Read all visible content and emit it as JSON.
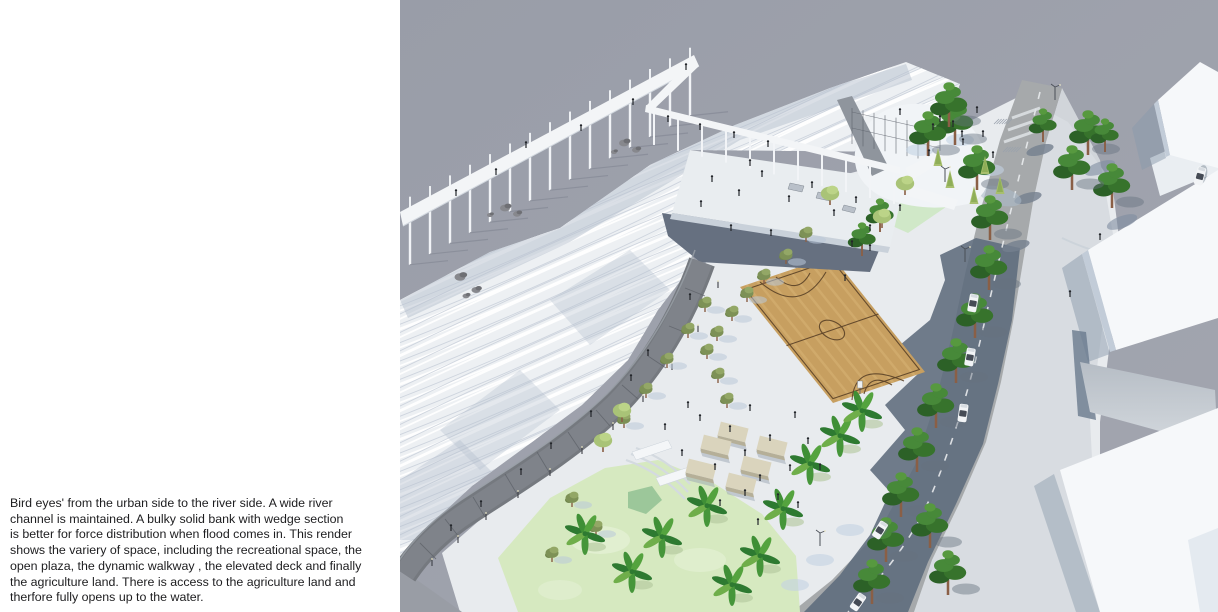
{
  "page": {
    "background": "#ffffff",
    "title": "Bird's eye architectural render page"
  },
  "caption": {
    "color": "#1d1d1f",
    "lines": [
      "Bird eyes' from the urban side to the river side. A wide river",
      "channel is maintained. A bulky solid bank with wedge section",
      "is better for force distribution when flood comes in. This render",
      "shows the variery of space, including the recreational space, the",
      "open plaza, the dynamic walkway , the elevated deck and finally",
      "the agriculture land. There is access to the agriculture land and",
      "therfore fully opens up to the water."
    ]
  },
  "render": {
    "x": 400,
    "width": 818,
    "height": 612,
    "palette": {
      "bg_a": "#999da8",
      "bg_b": "#a3a6b0",
      "white_structure": "#f3f5f7",
      "ground": "#e8ebee",
      "stripe_base": "#edf0f3",
      "stripe_shadow": "#b5bfce",
      "furrow": "#c6cdd8",
      "walkway": "#75797f",
      "walkway_inner": "#7f838a",
      "wedge": "#999da5",
      "road": "#a6a9ab",
      "road_shadow": "#5d6b7c",
      "sidewalk": "#d6dadf",
      "lane": "#e9ebed",
      "court": "#c79f60",
      "court_streak": "#d7b376",
      "court_line": "#5a4127",
      "grass": "#d6e9c0",
      "grass_light": "#e3f0d3",
      "grass_top": "#cfe8c5",
      "pond": "#9cc79a",
      "tree_dark": "#2c6127",
      "tree_mid": "#37732c",
      "tree_hi": "#478939",
      "tree_top": "#57993f",
      "olive": "#7d9156",
      "olive_hi": "#93a766",
      "light_tree": "#a9c377",
      "light_tree_hi": "#bcd488",
      "banana": "#2e7a31",
      "banana_hi": "#54a33e",
      "conifer": "#a8bf6e",
      "trunk": "#8a5f46",
      "trunk_banana": "#996b4e",
      "bench_top": "#dad4bd",
      "bench_side": "#b5af98",
      "car_body": "#f2f4f6",
      "car_glass": "#454b55",
      "people": "#23262b",
      "rock_a": "#87888d",
      "rock_b": "#6e6f74",
      "shadow_blue": "#b9c8d8",
      "building": "#f6f8fa",
      "building_side": "#c2ccd8",
      "building_shadow": "#8a99ab",
      "underdeck": "#667080",
      "deck": "#e9edf0"
    },
    "scene": {
      "people": [
        [
          56,
          196
        ],
        [
          96,
          175
        ],
        [
          126,
          148
        ],
        [
          181,
          131
        ],
        [
          233,
          105
        ],
        [
          286,
          70
        ],
        [
          268,
          122
        ],
        [
          300,
          130
        ],
        [
          334,
          138
        ],
        [
          368,
          147
        ],
        [
          312,
          182
        ],
        [
          339,
          196
        ],
        [
          362,
          177
        ],
        [
          389,
          202
        ],
        [
          412,
          188
        ],
        [
          434,
          216
        ],
        [
          456,
          203
        ],
        [
          470,
          231
        ],
        [
          350,
          166
        ],
        [
          301,
          207
        ],
        [
          331,
          231
        ],
        [
          371,
          236
        ],
        [
          500,
          115
        ],
        [
          533,
          130
        ],
        [
          553,
          127
        ],
        [
          562,
          137
        ],
        [
          577,
          113
        ],
        [
          583,
          137
        ],
        [
          563,
          145
        ],
        [
          593,
          158
        ],
        [
          540,
          122
        ],
        [
          529,
          156
        ],
        [
          500,
          211
        ],
        [
          470,
          251
        ],
        [
          445,
          281
        ],
        [
          248,
          356
        ],
        [
          231,
          381
        ],
        [
          191,
          417
        ],
        [
          151,
          449
        ],
        [
          121,
          475
        ],
        [
          81,
          507
        ],
        [
          51,
          531
        ],
        [
          290,
          300
        ],
        [
          330,
          432
        ],
        [
          345,
          456
        ],
        [
          360,
          481
        ],
        [
          315,
          470
        ],
        [
          350,
          411
        ],
        [
          300,
          421
        ],
        [
          370,
          441
        ],
        [
          390,
          471
        ],
        [
          345,
          496
        ],
        [
          320,
          506
        ],
        [
          282,
          456
        ],
        [
          265,
          430
        ],
        [
          288,
          408
        ],
        [
          395,
          418
        ],
        [
          408,
          444
        ],
        [
          420,
          470
        ],
        [
          378,
          500
        ],
        [
          398,
          508
        ],
        [
          358,
          525
        ],
        [
          670,
          297
        ],
        [
          700,
          240
        ],
        [
          452,
          247
        ]
      ],
      "trees_pine_big": [
        [
          555,
          145
        ],
        [
          577,
          190
        ],
        [
          590,
          240
        ],
        [
          589,
          290
        ],
        [
          575,
          338
        ],
        [
          556,
          383
        ],
        [
          536,
          428
        ],
        [
          517,
          472
        ],
        [
          501,
          517
        ],
        [
          486,
          562
        ],
        [
          472,
          604
        ],
        [
          688,
          155
        ],
        [
          712,
          208
        ],
        [
          672,
          190
        ],
        [
          530,
          548
        ],
        [
          548,
          595
        ],
        [
          528,
          156
        ],
        [
          549,
          127
        ]
      ],
      "trees_pine": [
        [
          643,
          142
        ],
        [
          705,
          152
        ],
        [
          480,
          232
        ],
        [
          462,
          256
        ]
      ],
      "trees_olive": [
        [
          406,
          242
        ],
        [
          386,
          264
        ],
        [
          364,
          284
        ],
        [
          347,
          302
        ],
        [
          332,
          321
        ],
        [
          317,
          341
        ],
        [
          307,
          359
        ],
        [
          318,
          383
        ],
        [
          327,
          408
        ],
        [
          224,
          428
        ],
        [
          246,
          398
        ],
        [
          267,
          368
        ],
        [
          288,
          338
        ],
        [
          305,
          312
        ],
        [
          172,
          507
        ],
        [
          196,
          536
        ],
        [
          152,
          562
        ]
      ],
      "trees_light": [
        [
          505,
          195
        ],
        [
          482,
          228
        ],
        [
          222,
          422
        ],
        [
          203,
          452
        ],
        [
          430,
          205
        ]
      ],
      "trees_banana": [
        [
          232,
          583
        ],
        [
          307,
          517
        ],
        [
          360,
          567
        ],
        [
          383,
          520
        ],
        [
          410,
          475
        ],
        [
          440,
          447
        ],
        [
          462,
          422
        ],
        [
          185,
          545
        ],
        [
          262,
          548
        ],
        [
          332,
          596
        ]
      ],
      "trees_conifer": [
        [
          538,
          170
        ],
        [
          550,
          192
        ],
        [
          585,
          178
        ],
        [
          600,
          198
        ],
        [
          574,
          208
        ]
      ],
      "cars": [
        [
          573,
          303,
          -80
        ],
        [
          570,
          357,
          -80
        ],
        [
          563,
          413,
          -82
        ],
        [
          480,
          530,
          -58
        ],
        [
          458,
          602,
          -55
        ],
        [
          800,
          176,
          -75
        ]
      ],
      "benches": [
        [
          333,
          432
        ],
        [
          316,
          445
        ],
        [
          372,
          446
        ],
        [
          301,
          469
        ],
        [
          356,
          466
        ],
        [
          341,
          483
        ]
      ],
      "rocks": [
        [
          60,
          277,
          1.1
        ],
        [
          76,
          290,
          0.9
        ],
        [
          66,
          296,
          0.7
        ],
        [
          105,
          208,
          1.0
        ],
        [
          117,
          214,
          0.8
        ],
        [
          90,
          215,
          0.6
        ],
        [
          224,
          143,
          1.0
        ],
        [
          236,
          150,
          0.8
        ],
        [
          214,
          152,
          0.6
        ]
      ],
      "lamps": [
        [
          655,
          100
        ],
        [
          565,
          262
        ],
        [
          420,
          546
        ],
        [
          545,
          182
        ]
      ],
      "walkway_posts": [
        [
          318,
          288
        ],
        [
          298,
          332
        ],
        [
          272,
          370
        ],
        [
          243,
          402
        ],
        [
          213,
          430
        ],
        [
          182,
          454
        ],
        [
          150,
          476
        ],
        [
          118,
          498
        ],
        [
          86,
          520
        ],
        [
          58,
          543
        ],
        [
          32,
          566
        ]
      ],
      "walkway_joints": [
        [
          295,
          292,
          10,
          4
        ],
        [
          279,
          330,
          10,
          4
        ],
        [
          257,
          362,
          9,
          6
        ],
        [
          230,
          392,
          8,
          7
        ],
        [
          203,
          418,
          7,
          8
        ],
        [
          174,
          441,
          6,
          9
        ],
        [
          143,
          462,
          6,
          10
        ],
        [
          111,
          484,
          6,
          10
        ],
        [
          79,
          507,
          6,
          10
        ],
        [
          52,
          528,
          7,
          9
        ],
        [
          28,
          551,
          8,
          8
        ]
      ]
    }
  }
}
